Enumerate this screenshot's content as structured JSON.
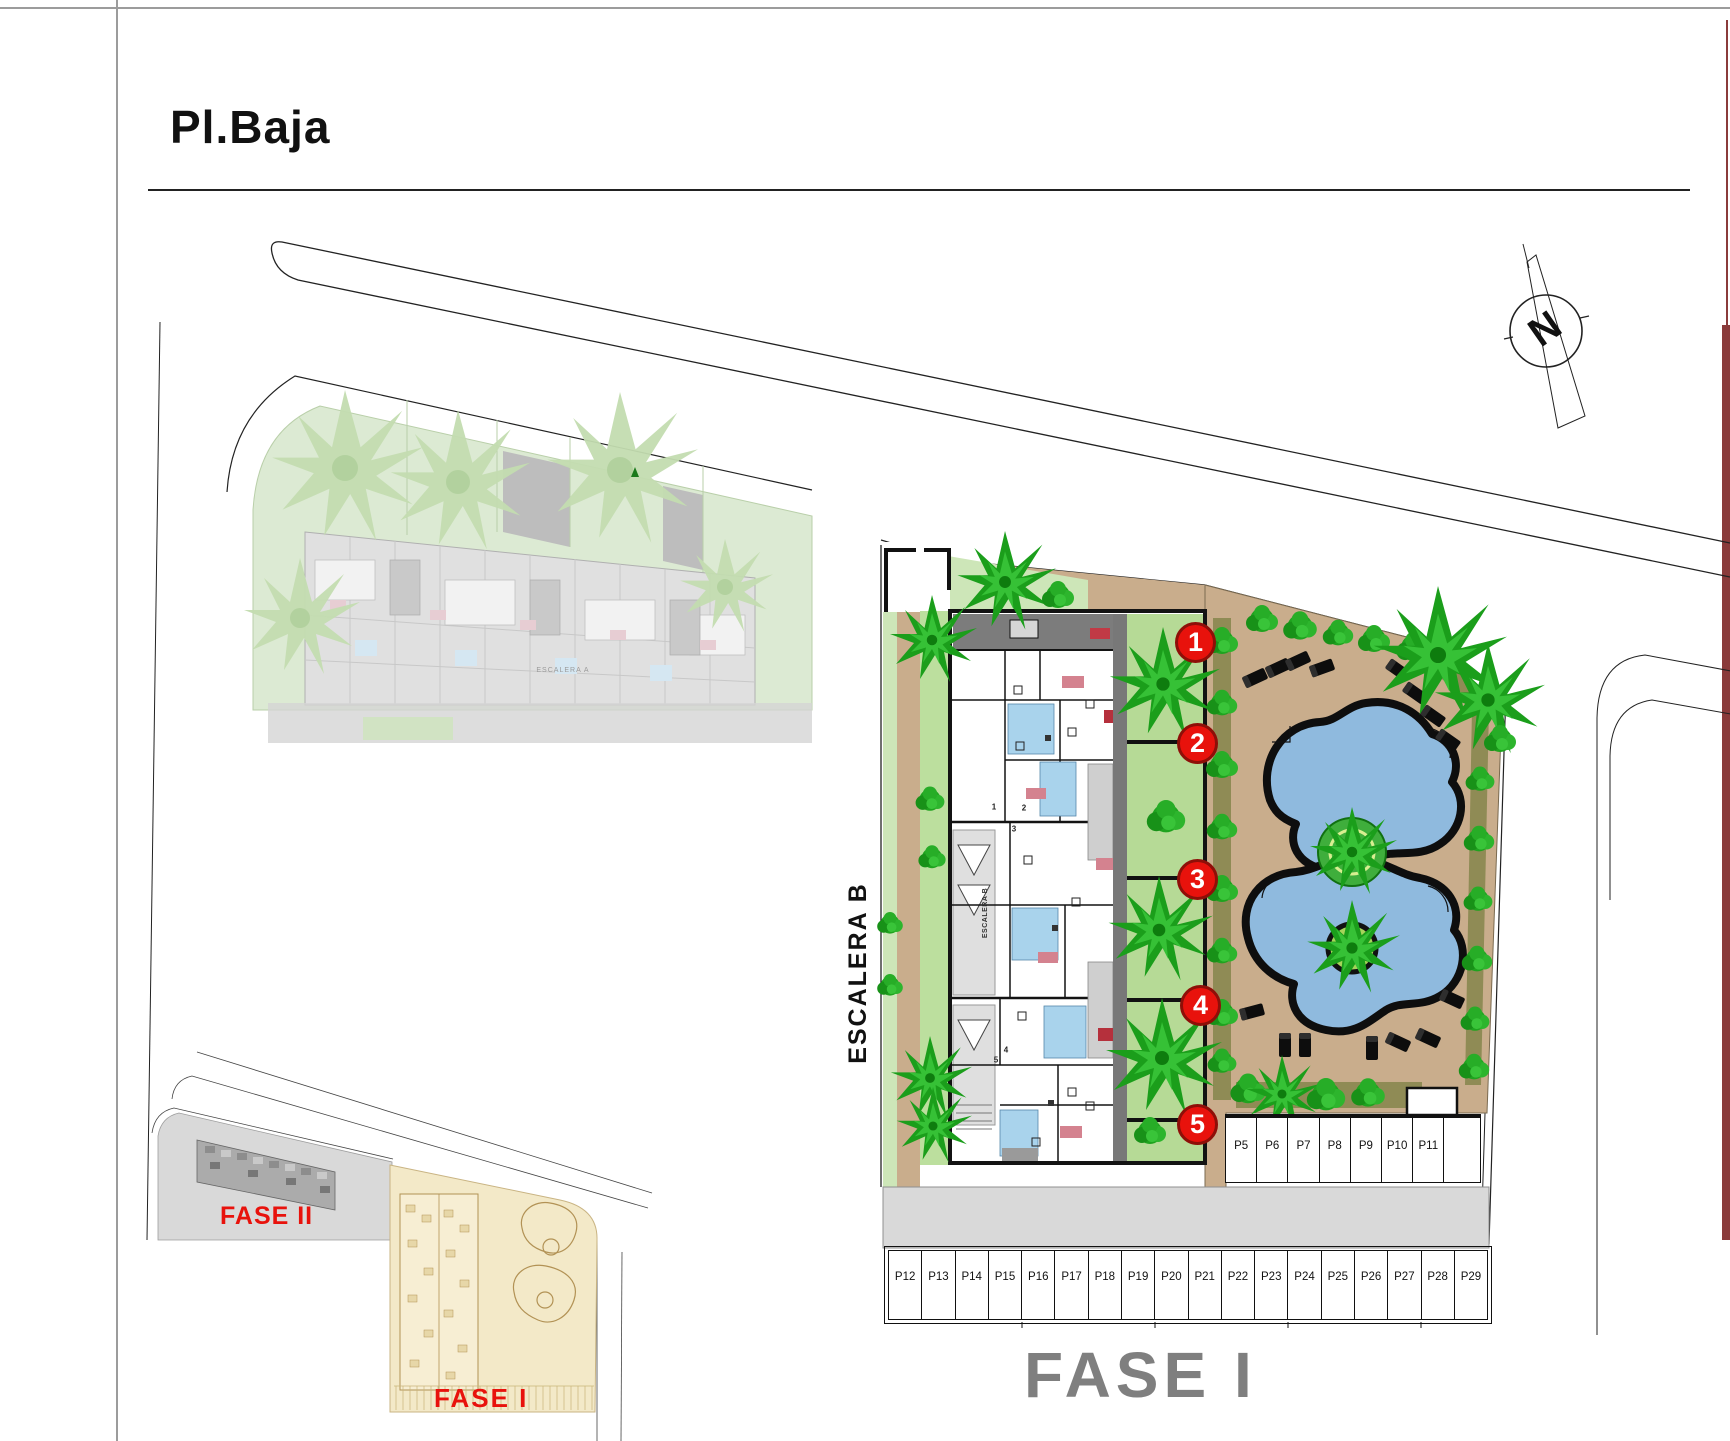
{
  "title": "Pl.Baja",
  "compass": {
    "letter": "N"
  },
  "labels": {
    "escalera_b": "ESCALERA B",
    "escalera_b_small": "ESCALERA B",
    "escalera_a_small": "ESCALERA A",
    "phase_caption": "FASE I",
    "inset_phase_2": "FASE II",
    "inset_phase_1": "FASE I"
  },
  "unit_markers": [
    {
      "number": "1"
    },
    {
      "number": "2"
    },
    {
      "number": "3"
    },
    {
      "number": "4"
    },
    {
      "number": "5"
    }
  ],
  "plan_unit_numbers": [
    "1",
    "2",
    "3",
    "4",
    "5"
  ],
  "parking": {
    "row_upper": [
      "P5",
      "P6",
      "P7",
      "P8",
      "P9",
      "P10",
      "P11"
    ],
    "row_lower": [
      "P12",
      "P13",
      "P14",
      "P15",
      "P16",
      "P17",
      "P18",
      "P19",
      "P20",
      "P21",
      "P22",
      "P23",
      "P24",
      "P25",
      "P26",
      "P27",
      "P28",
      "P29"
    ]
  },
  "colors": {
    "marker_red": "#e8120c",
    "phase_text_red": "#e8120c",
    "phase_caption_gray": "#7f7f7f",
    "pool_blue": "#8fbade",
    "terrace_tan": "#c9ad8c",
    "landscape_green": "#1fa31f",
    "light_green": "#cde6b8",
    "faded_site_green": "#dcead3",
    "road_gray": "#d9d9d9",
    "edge_maroon": "#8a3b3b"
  }
}
